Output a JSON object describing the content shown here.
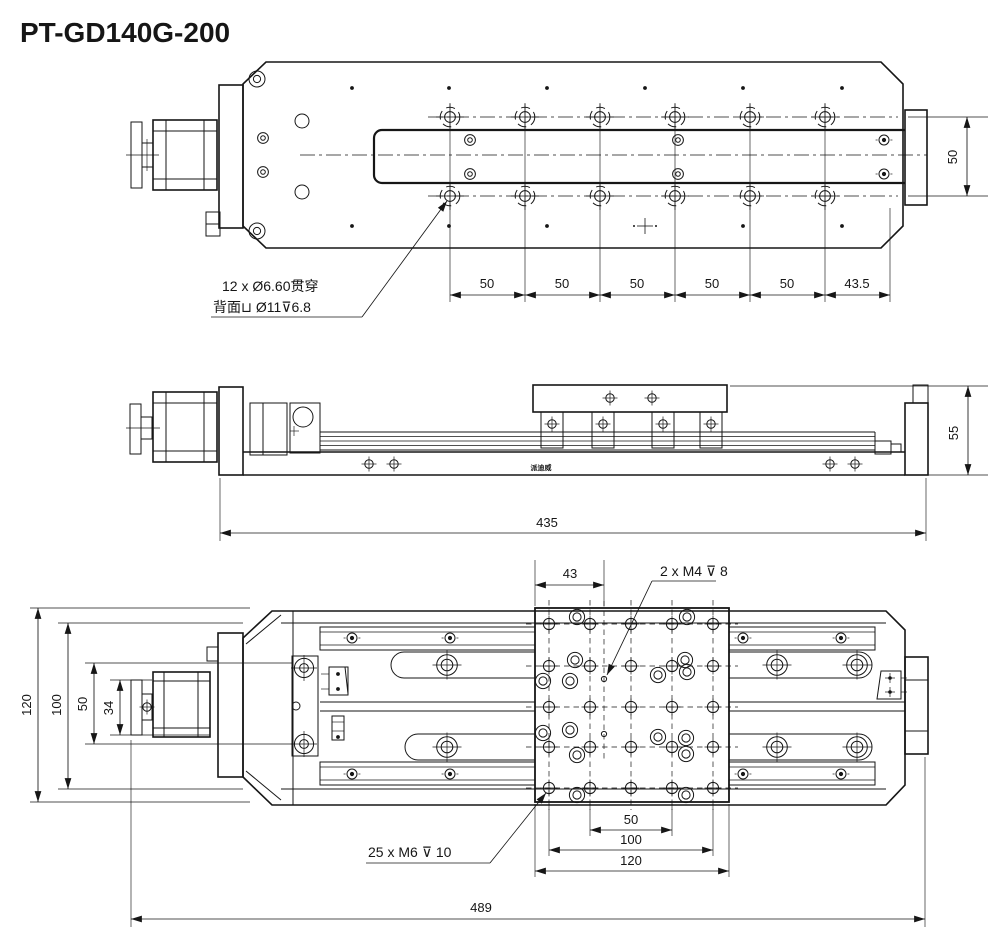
{
  "title": "PT-GD140G-200",
  "top_view": {
    "callout_cbore": {
      "line1": "12 x Ø6.60贯穿",
      "line2": "背面⊔ Ø11⊽6.8"
    },
    "dim_hole_spacing": [
      "50",
      "50",
      "50",
      "50",
      "50"
    ],
    "dim_end": "43.5",
    "dim_hole_row_width": "50"
  },
  "side_view": {
    "dim_height": "55",
    "dim_length": "435",
    "brand_label": "派迪威"
  },
  "bottom_view": {
    "dim_plate_offset": "43",
    "callout_m4": "2 x M4 ⊽ 8",
    "callout_m6": "25 x M6 ⊽ 10",
    "dims_left": {
      "overall": "120",
      "body": "100",
      "block": "50",
      "knob": "34"
    },
    "dims_bottom": {
      "inner": "50",
      "mid": "100",
      "plate": "120"
    },
    "dim_overall_length": "489"
  }
}
